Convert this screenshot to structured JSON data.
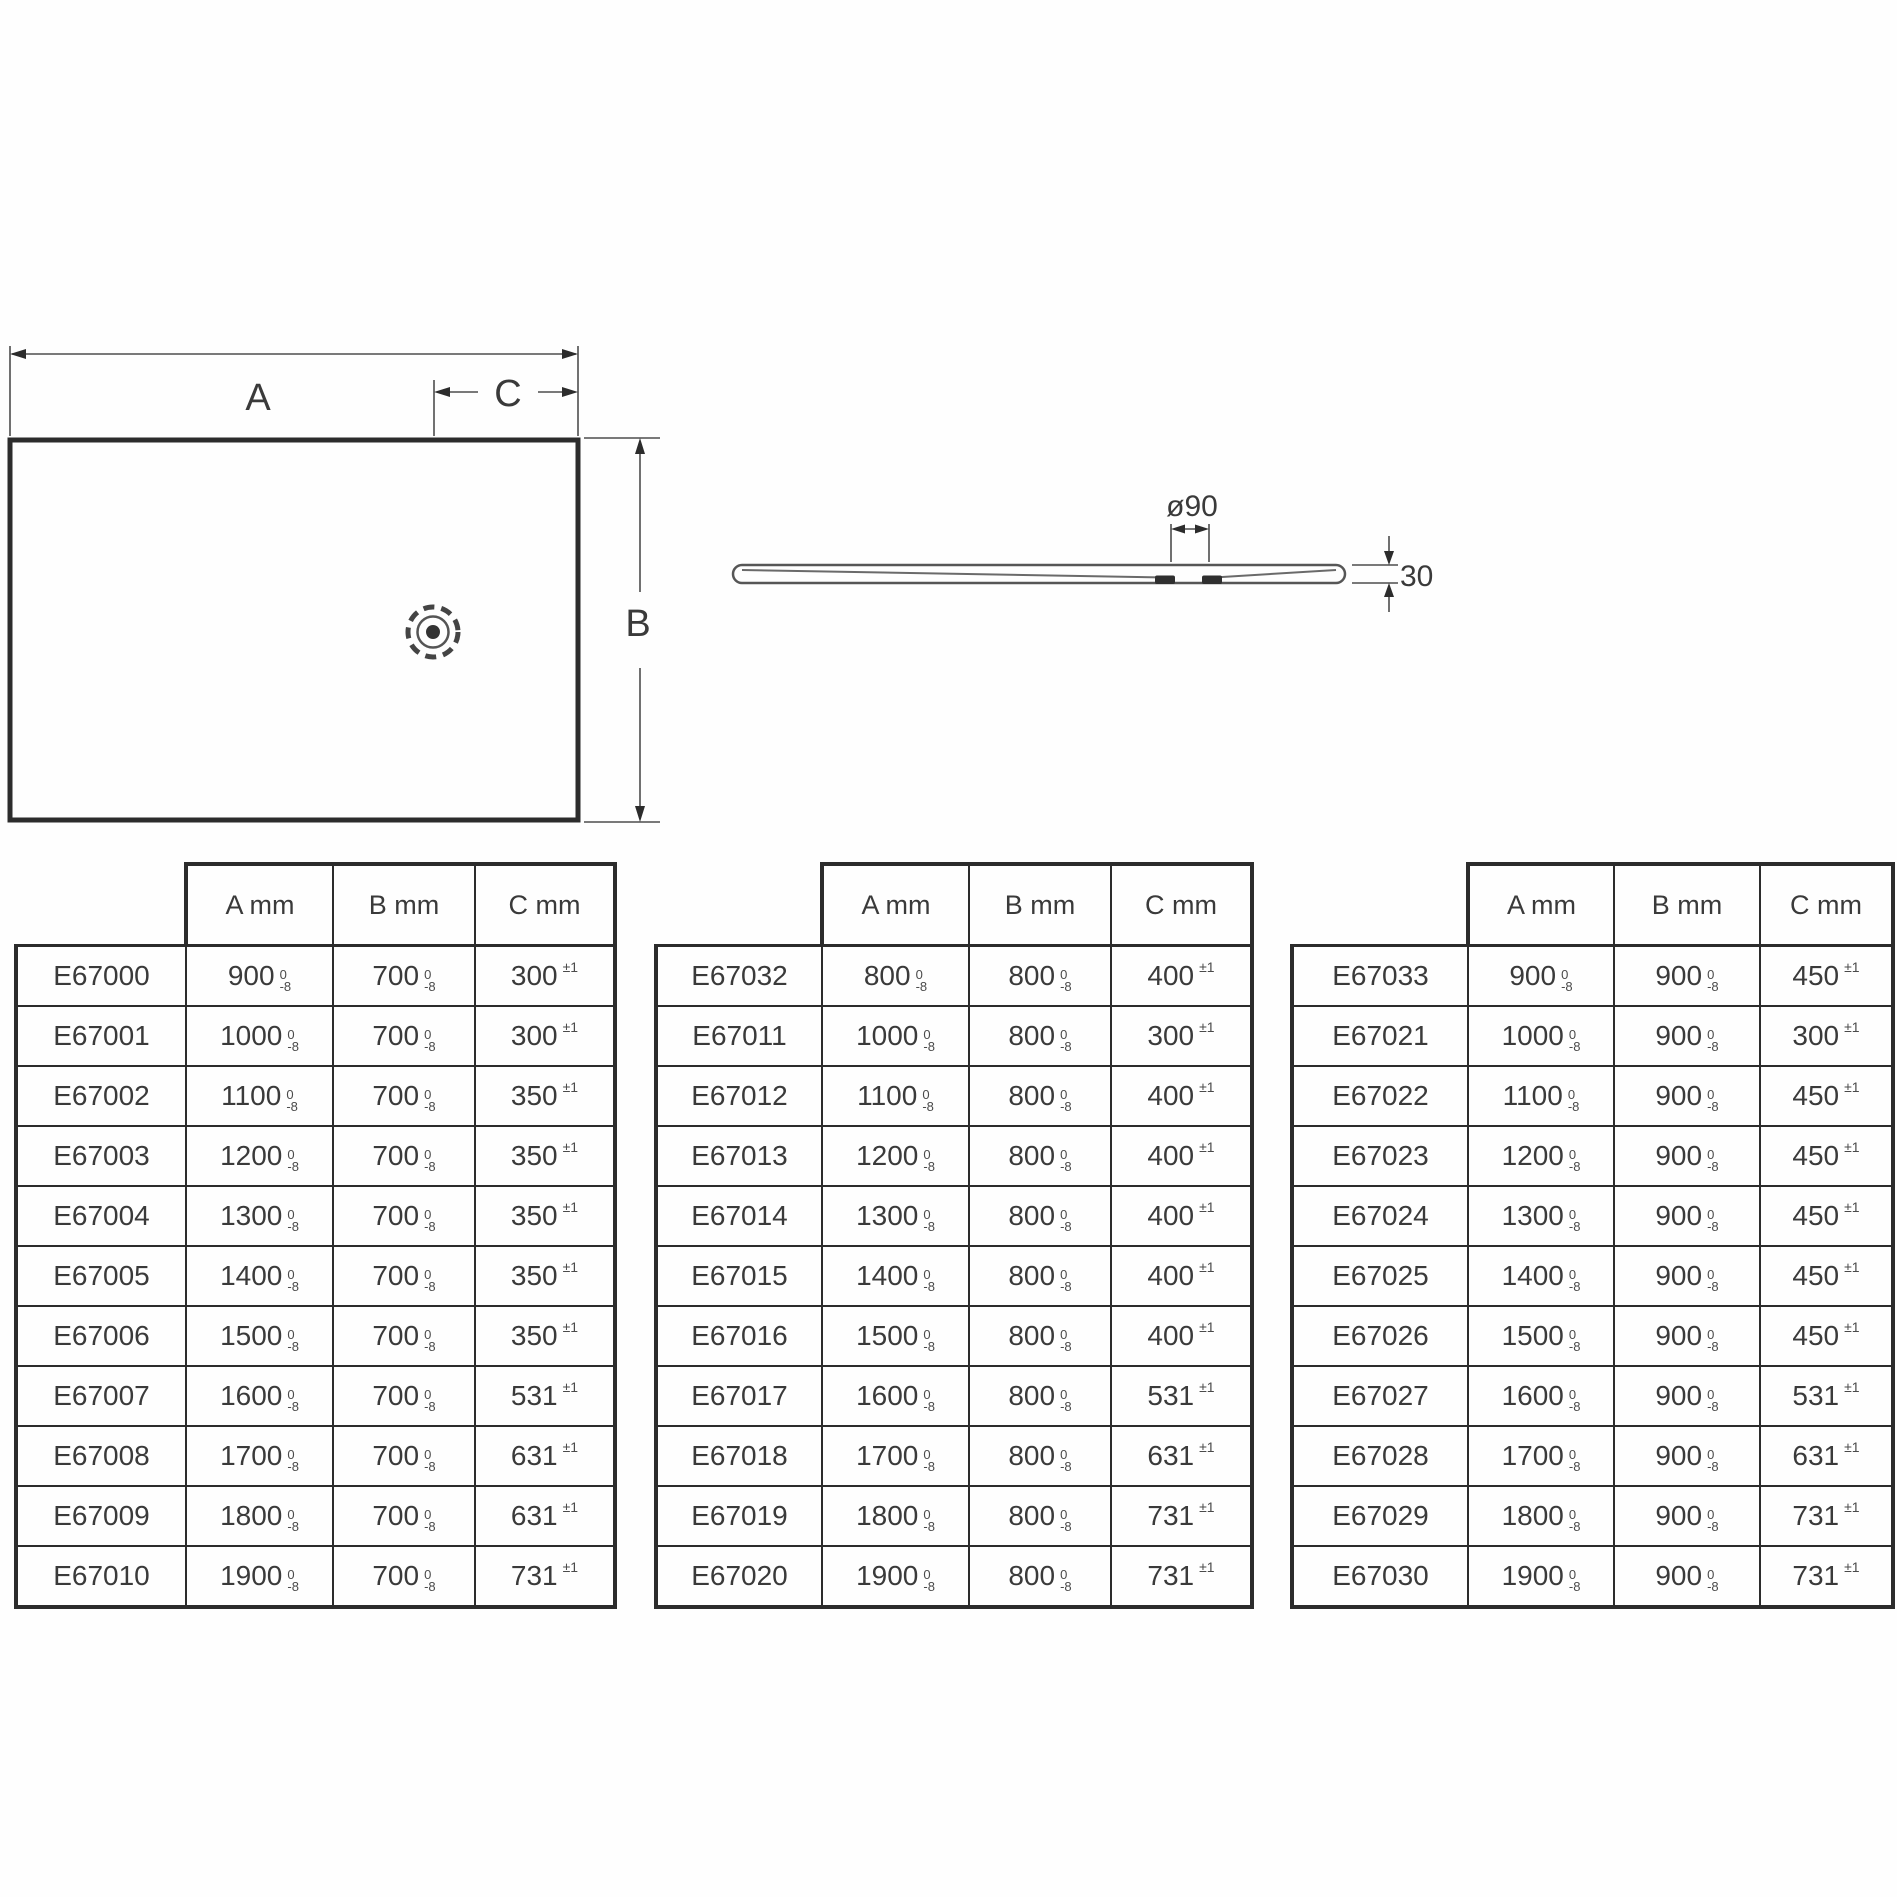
{
  "drawing": {
    "plan": {
      "a_label": "A",
      "b_label": "B",
      "c_label": "C"
    },
    "profile": {
      "diameter_label": "ø90",
      "thickness_label": "30"
    }
  },
  "table_header": {
    "a": "A mm",
    "b": "B mm",
    "c": "C mm"
  },
  "tolerances": {
    "ab_top": "0",
    "ab_bottom": "-8",
    "c": "±1"
  },
  "tables": [
    {
      "rows": [
        {
          "code": "E67000",
          "a": "900",
          "b": "700",
          "c": "300"
        },
        {
          "code": "E67001",
          "a": "1000",
          "b": "700",
          "c": "300"
        },
        {
          "code": "E67002",
          "a": "1100",
          "b": "700",
          "c": "350"
        },
        {
          "code": "E67003",
          "a": "1200",
          "b": "700",
          "c": "350"
        },
        {
          "code": "E67004",
          "a": "1300",
          "b": "700",
          "c": "350"
        },
        {
          "code": "E67005",
          "a": "1400",
          "b": "700",
          "c": "350"
        },
        {
          "code": "E67006",
          "a": "1500",
          "b": "700",
          "c": "350"
        },
        {
          "code": "E67007",
          "a": "1600",
          "b": "700",
          "c": "531"
        },
        {
          "code": "E67008",
          "a": "1700",
          "b": "700",
          "c": "631"
        },
        {
          "code": "E67009",
          "a": "1800",
          "b": "700",
          "c": "631"
        },
        {
          "code": "E67010",
          "a": "1900",
          "b": "700",
          "c": "731"
        }
      ]
    },
    {
      "rows": [
        {
          "code": "E67032",
          "a": "800",
          "b": "800",
          "c": "400"
        },
        {
          "code": "E67011",
          "a": "1000",
          "b": "800",
          "c": "300"
        },
        {
          "code": "E67012",
          "a": "1100",
          "b": "800",
          "c": "400"
        },
        {
          "code": "E67013",
          "a": "1200",
          "b": "800",
          "c": "400"
        },
        {
          "code": "E67014",
          "a": "1300",
          "b": "800",
          "c": "400"
        },
        {
          "code": "E67015",
          "a": "1400",
          "b": "800",
          "c": "400"
        },
        {
          "code": "E67016",
          "a": "1500",
          "b": "800",
          "c": "400"
        },
        {
          "code": "E67017",
          "a": "1600",
          "b": "800",
          "c": "531"
        },
        {
          "code": "E67018",
          "a": "1700",
          "b": "800",
          "c": "631"
        },
        {
          "code": "E67019",
          "a": "1800",
          "b": "800",
          "c": "731"
        },
        {
          "code": "E67020",
          "a": "1900",
          "b": "800",
          "c": "731"
        }
      ]
    },
    {
      "rows": [
        {
          "code": "E67033",
          "a": "900",
          "b": "900",
          "c": "450"
        },
        {
          "code": "E67021",
          "a": "1000",
          "b": "900",
          "c": "300"
        },
        {
          "code": "E67022",
          "a": "1100",
          "b": "900",
          "c": "450"
        },
        {
          "code": "E67023",
          "a": "1200",
          "b": "900",
          "c": "450"
        },
        {
          "code": "E67024",
          "a": "1300",
          "b": "900",
          "c": "450"
        },
        {
          "code": "E67025",
          "a": "1400",
          "b": "900",
          "c": "450"
        },
        {
          "code": "E67026",
          "a": "1500",
          "b": "900",
          "c": "450"
        },
        {
          "code": "E67027",
          "a": "1600",
          "b": "900",
          "c": "531"
        },
        {
          "code": "E67028",
          "a": "1700",
          "b": "900",
          "c": "631"
        },
        {
          "code": "E67029",
          "a": "1800",
          "b": "900",
          "c": "731"
        },
        {
          "code": "E67030",
          "a": "1900",
          "b": "900",
          "c": "731"
        }
      ]
    }
  ],
  "colors": {
    "line": "#4d4d4d",
    "heavy_line": "#2c2c2c",
    "text": "#3a3a3a"
  }
}
